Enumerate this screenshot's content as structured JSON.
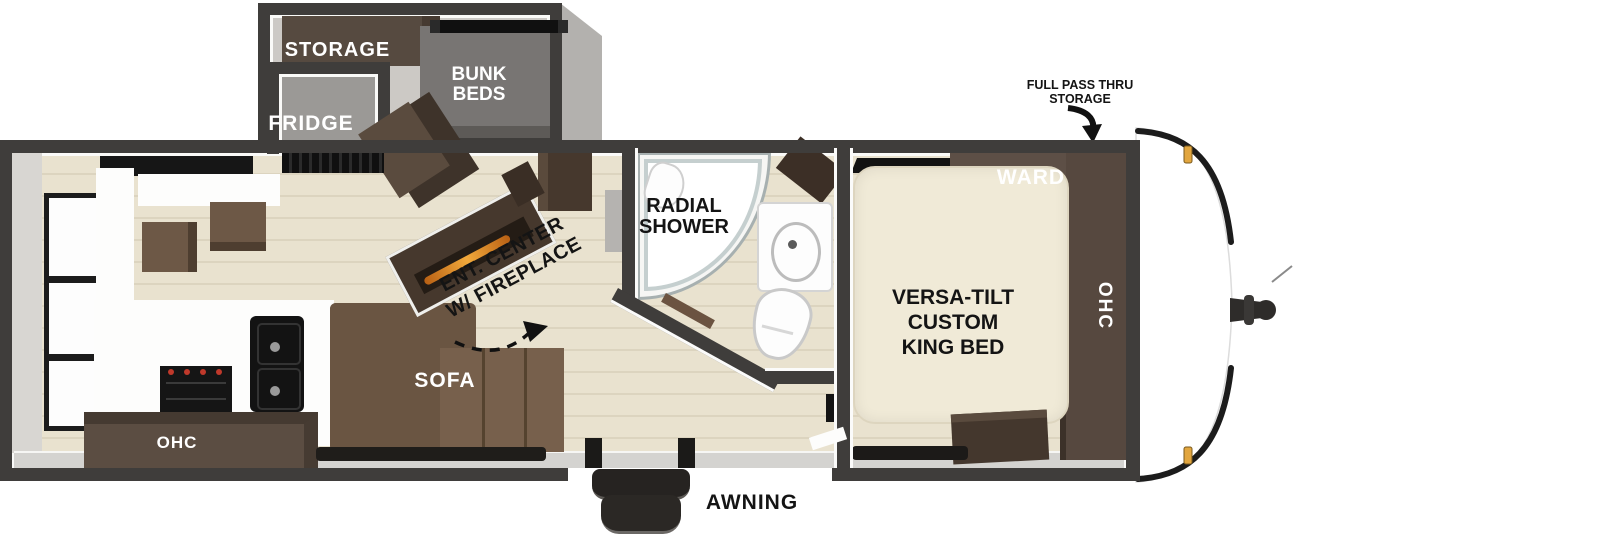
{
  "floorplan": {
    "title": "travel trailer floorplan",
    "slideout": {
      "storage_label": "STORAGE",
      "bunk_label_1": "BUNK",
      "bunk_label_2": "BEDS",
      "fridge_label": "FRIDGE"
    },
    "kitchen": {
      "ohc_label": "OHC"
    },
    "living": {
      "sofa_label": "SOFA",
      "ent_label_1": "ENT. CENTER",
      "ent_label_2": "W/ FIREPLACE"
    },
    "bathroom": {
      "shower_label_1": "RADIAL",
      "shower_label_2": "SHOWER"
    },
    "bedroom": {
      "ward_label": "WARD",
      "ohc_label": "OHC",
      "bed_label_1": "VERSA-TILT",
      "bed_label_2": "CUSTOM",
      "bed_label_3": "KING BED"
    },
    "callouts": {
      "pass_thru_line_1": "FULL PASS THRU",
      "pass_thru_line_2": "STORAGE",
      "awning_label": "AWNING"
    },
    "colors": {
      "wall": "#3f3d3b",
      "floor": "#e9e2cf",
      "cabinet_brown": "#52443a",
      "sofa_brown": "#6f5946",
      "bed_cream": "#f0ead7",
      "fireplace_glow": "#e89a33",
      "marker_light_amber": "#e2a63f",
      "label_black": "#141414",
      "label_white": "#ffffff"
    }
  }
}
